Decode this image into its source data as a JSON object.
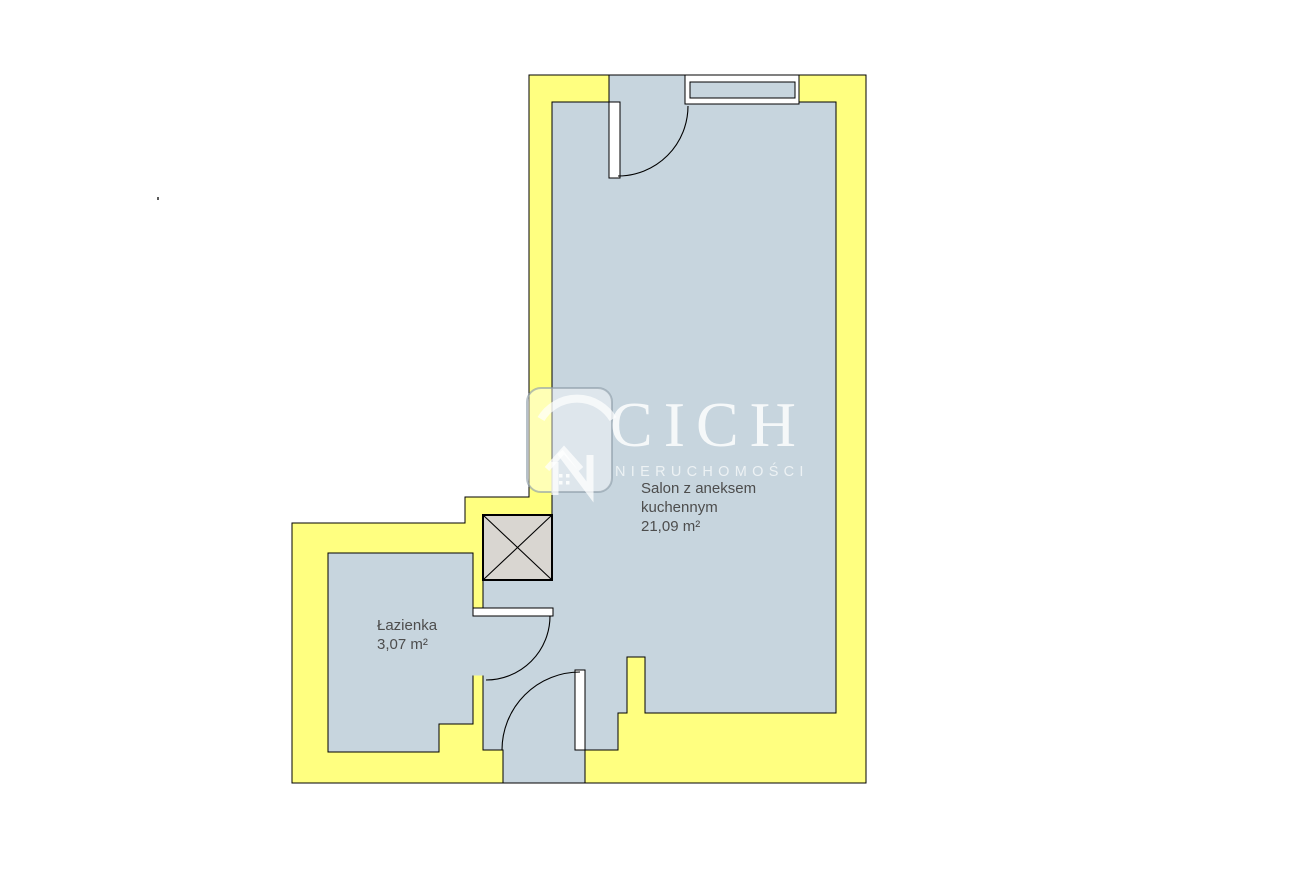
{
  "floorplan": {
    "watermark": {
      "brand": "CICH",
      "subtitle": "NIERUCHOMOŚCI"
    },
    "rooms": {
      "salon": {
        "name_line1": "Salon z aneksem",
        "name_line2": "kuchennym",
        "area": "21,09 m²"
      },
      "bathroom": {
        "name": "Łazienka",
        "area": "3,07 m²"
      }
    },
    "colors": {
      "wall_fill": "#FFFF80",
      "room_fill": "#C7D5DE",
      "shaft_fill": "#D9D6D1",
      "outline": "#000000",
      "label_text": "#4D4D4D",
      "watermark_text": "#FFFFFF"
    }
  }
}
